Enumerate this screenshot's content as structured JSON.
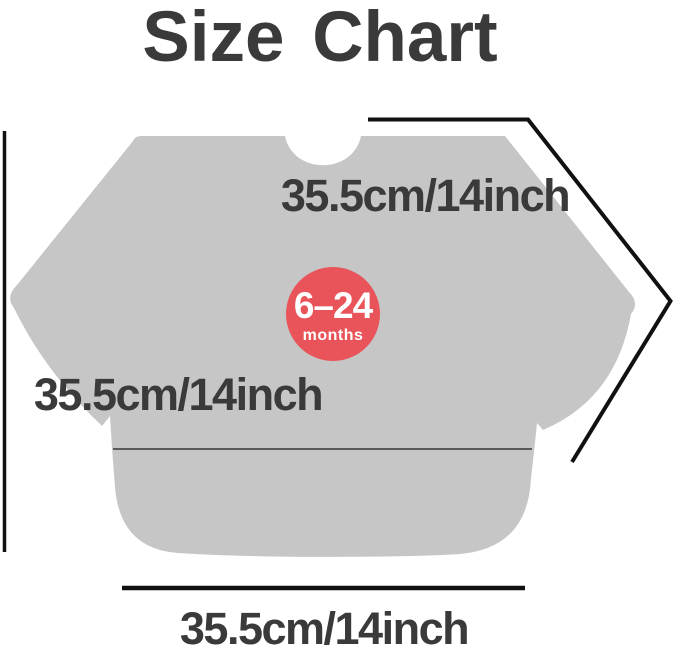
{
  "title": "Size Chart",
  "badge": {
    "age_range": "6–24",
    "age_unit": "months",
    "background_color": "#e9545a",
    "text_color": "#ffffff"
  },
  "measurements": {
    "sleeve_label": "35.5cm/14inch",
    "height_label": "35.5cm/14inch",
    "width_label": "35.5cm/14inch"
  },
  "colors": {
    "garment_fill": "#c6c6c6",
    "title_text": "#3a3a3a",
    "label_text": "#3a3a3a",
    "measure_line": "#111111",
    "pocket_line": "#4a4a4a",
    "background": "#ffffff"
  }
}
